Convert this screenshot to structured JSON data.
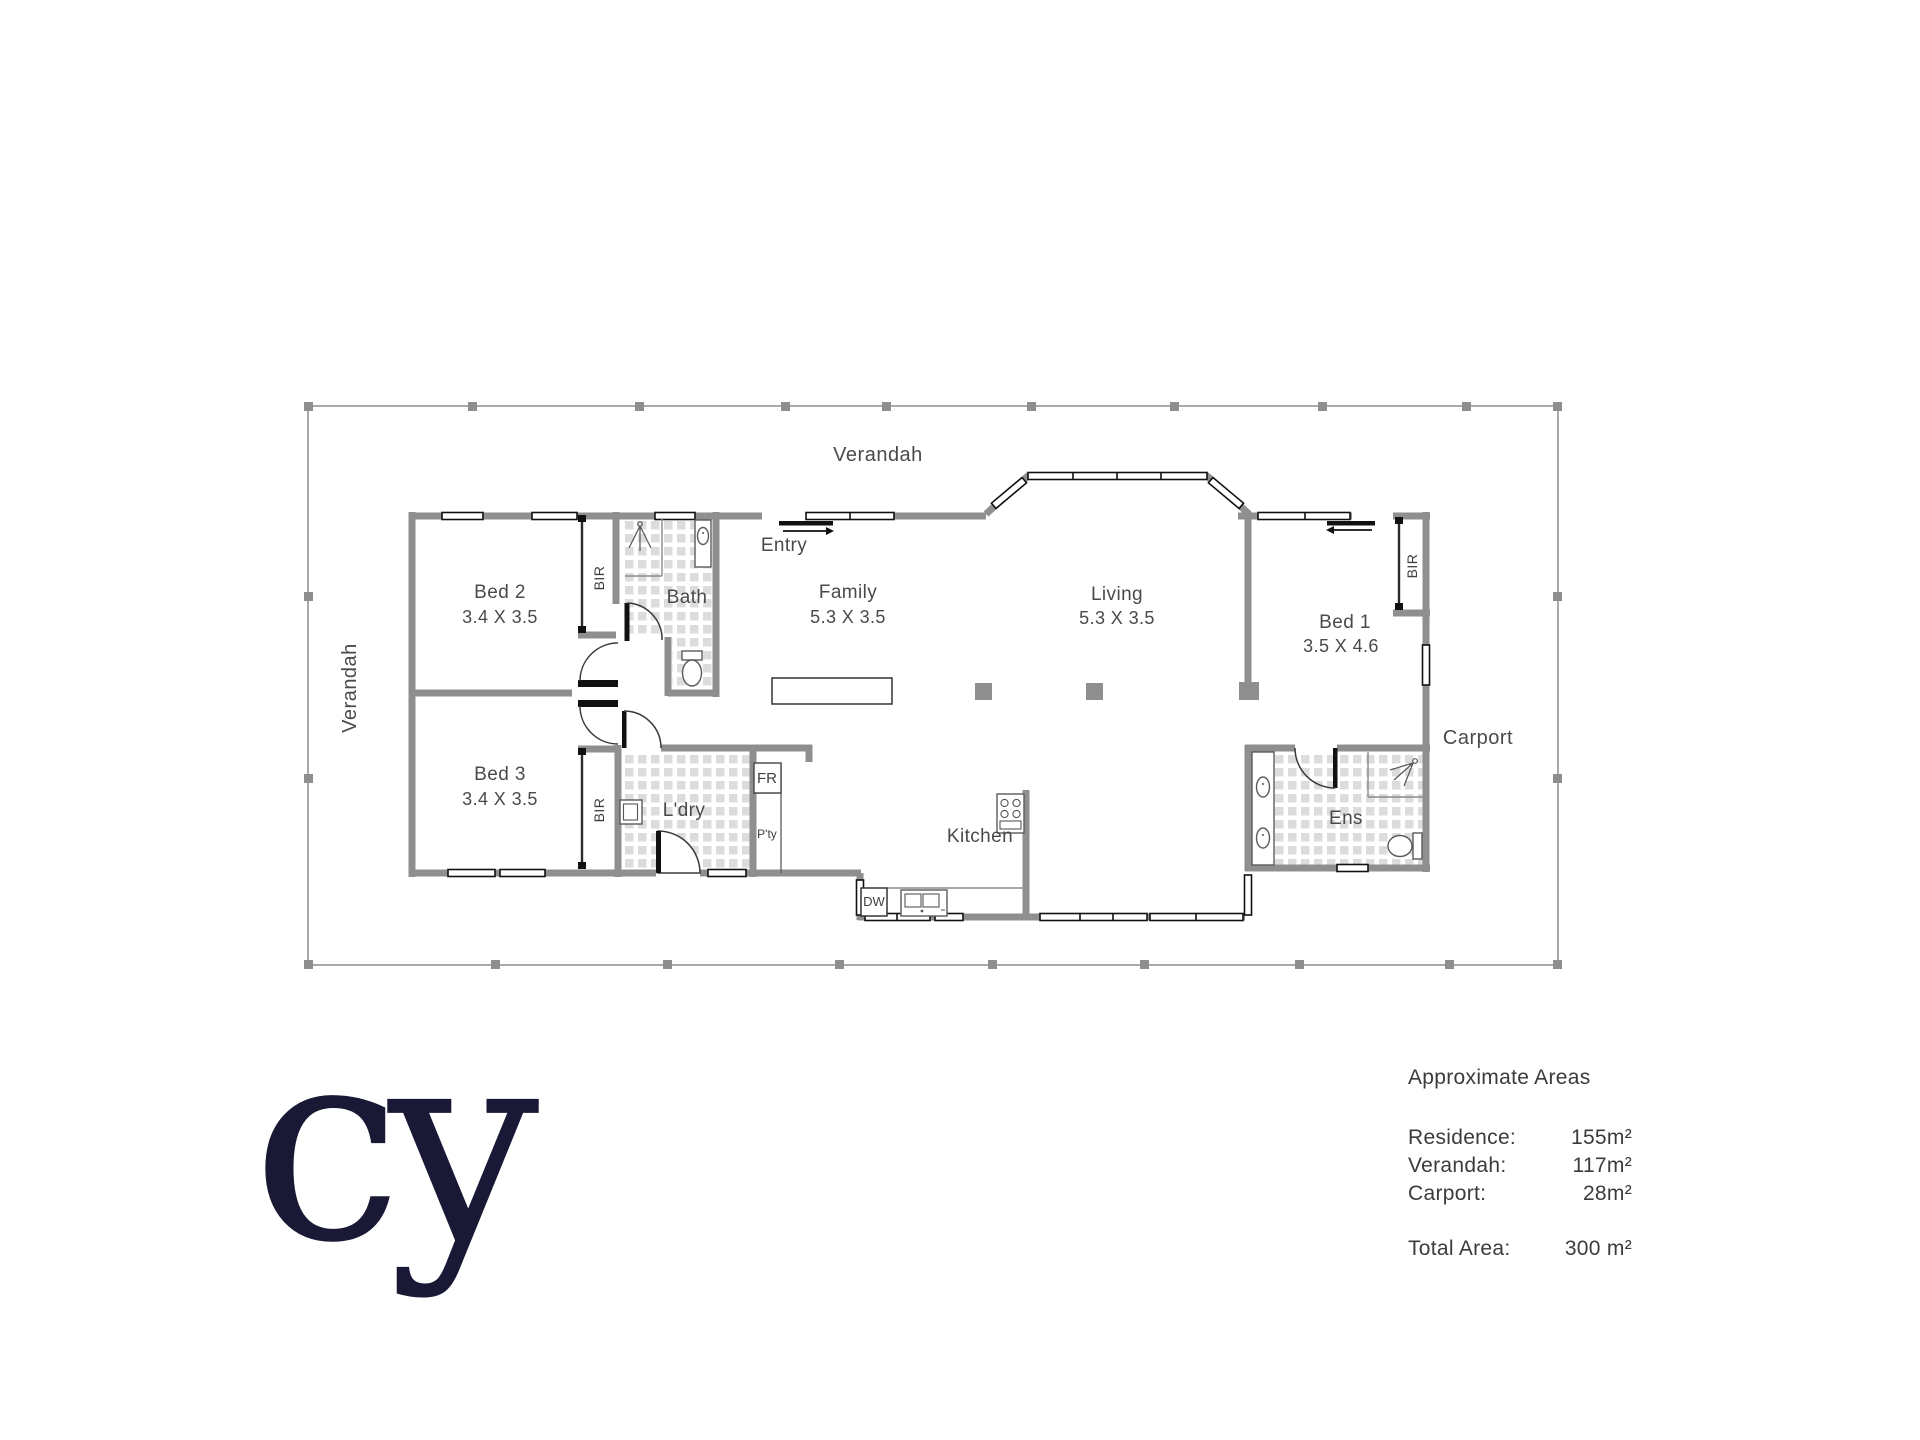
{
  "plan": {
    "verandah_label_top": "Verandah",
    "verandah_label_left": "Verandah",
    "entry_label": "Entry",
    "carport_label": "Carport",
    "rooms": {
      "bed2": {
        "name": "Bed 2",
        "dims": "3.4 X 3.5"
      },
      "bed3": {
        "name": "Bed 3",
        "dims": "3.4 X 3.5"
      },
      "family": {
        "name": "Family",
        "dims": "5.3 X 3.5"
      },
      "living": {
        "name": "Living",
        "dims": "5.3 X 3.5"
      },
      "bed1": {
        "name": "Bed 1",
        "dims": "3.5 X 4.6"
      },
      "bath": "Bath",
      "kitchen": "Kitchen",
      "laundry": "L'dry",
      "ensuite": "Ens"
    },
    "fixtures": {
      "bir": "BIR",
      "fridge": "FR",
      "pantry": "P'ty",
      "dishwasher": "DW"
    }
  },
  "areas": {
    "title": "Approximate Areas",
    "rows": [
      {
        "label": "Residence:",
        "value": "155m²"
      },
      {
        "label": "Verandah:",
        "value": "117m²"
      },
      {
        "label": "Carport:",
        "value": "28m²"
      }
    ],
    "total_label": "Total Area:",
    "total_value": "300 m²"
  },
  "logo": {
    "text": "cy"
  },
  "colors": {
    "wall": "#8f8f8f",
    "boundary": "#a9a9a9",
    "hatch_tile": "#dcdcdc",
    "label_text": "#4a4a4a",
    "logo_navy": "#191936"
  }
}
